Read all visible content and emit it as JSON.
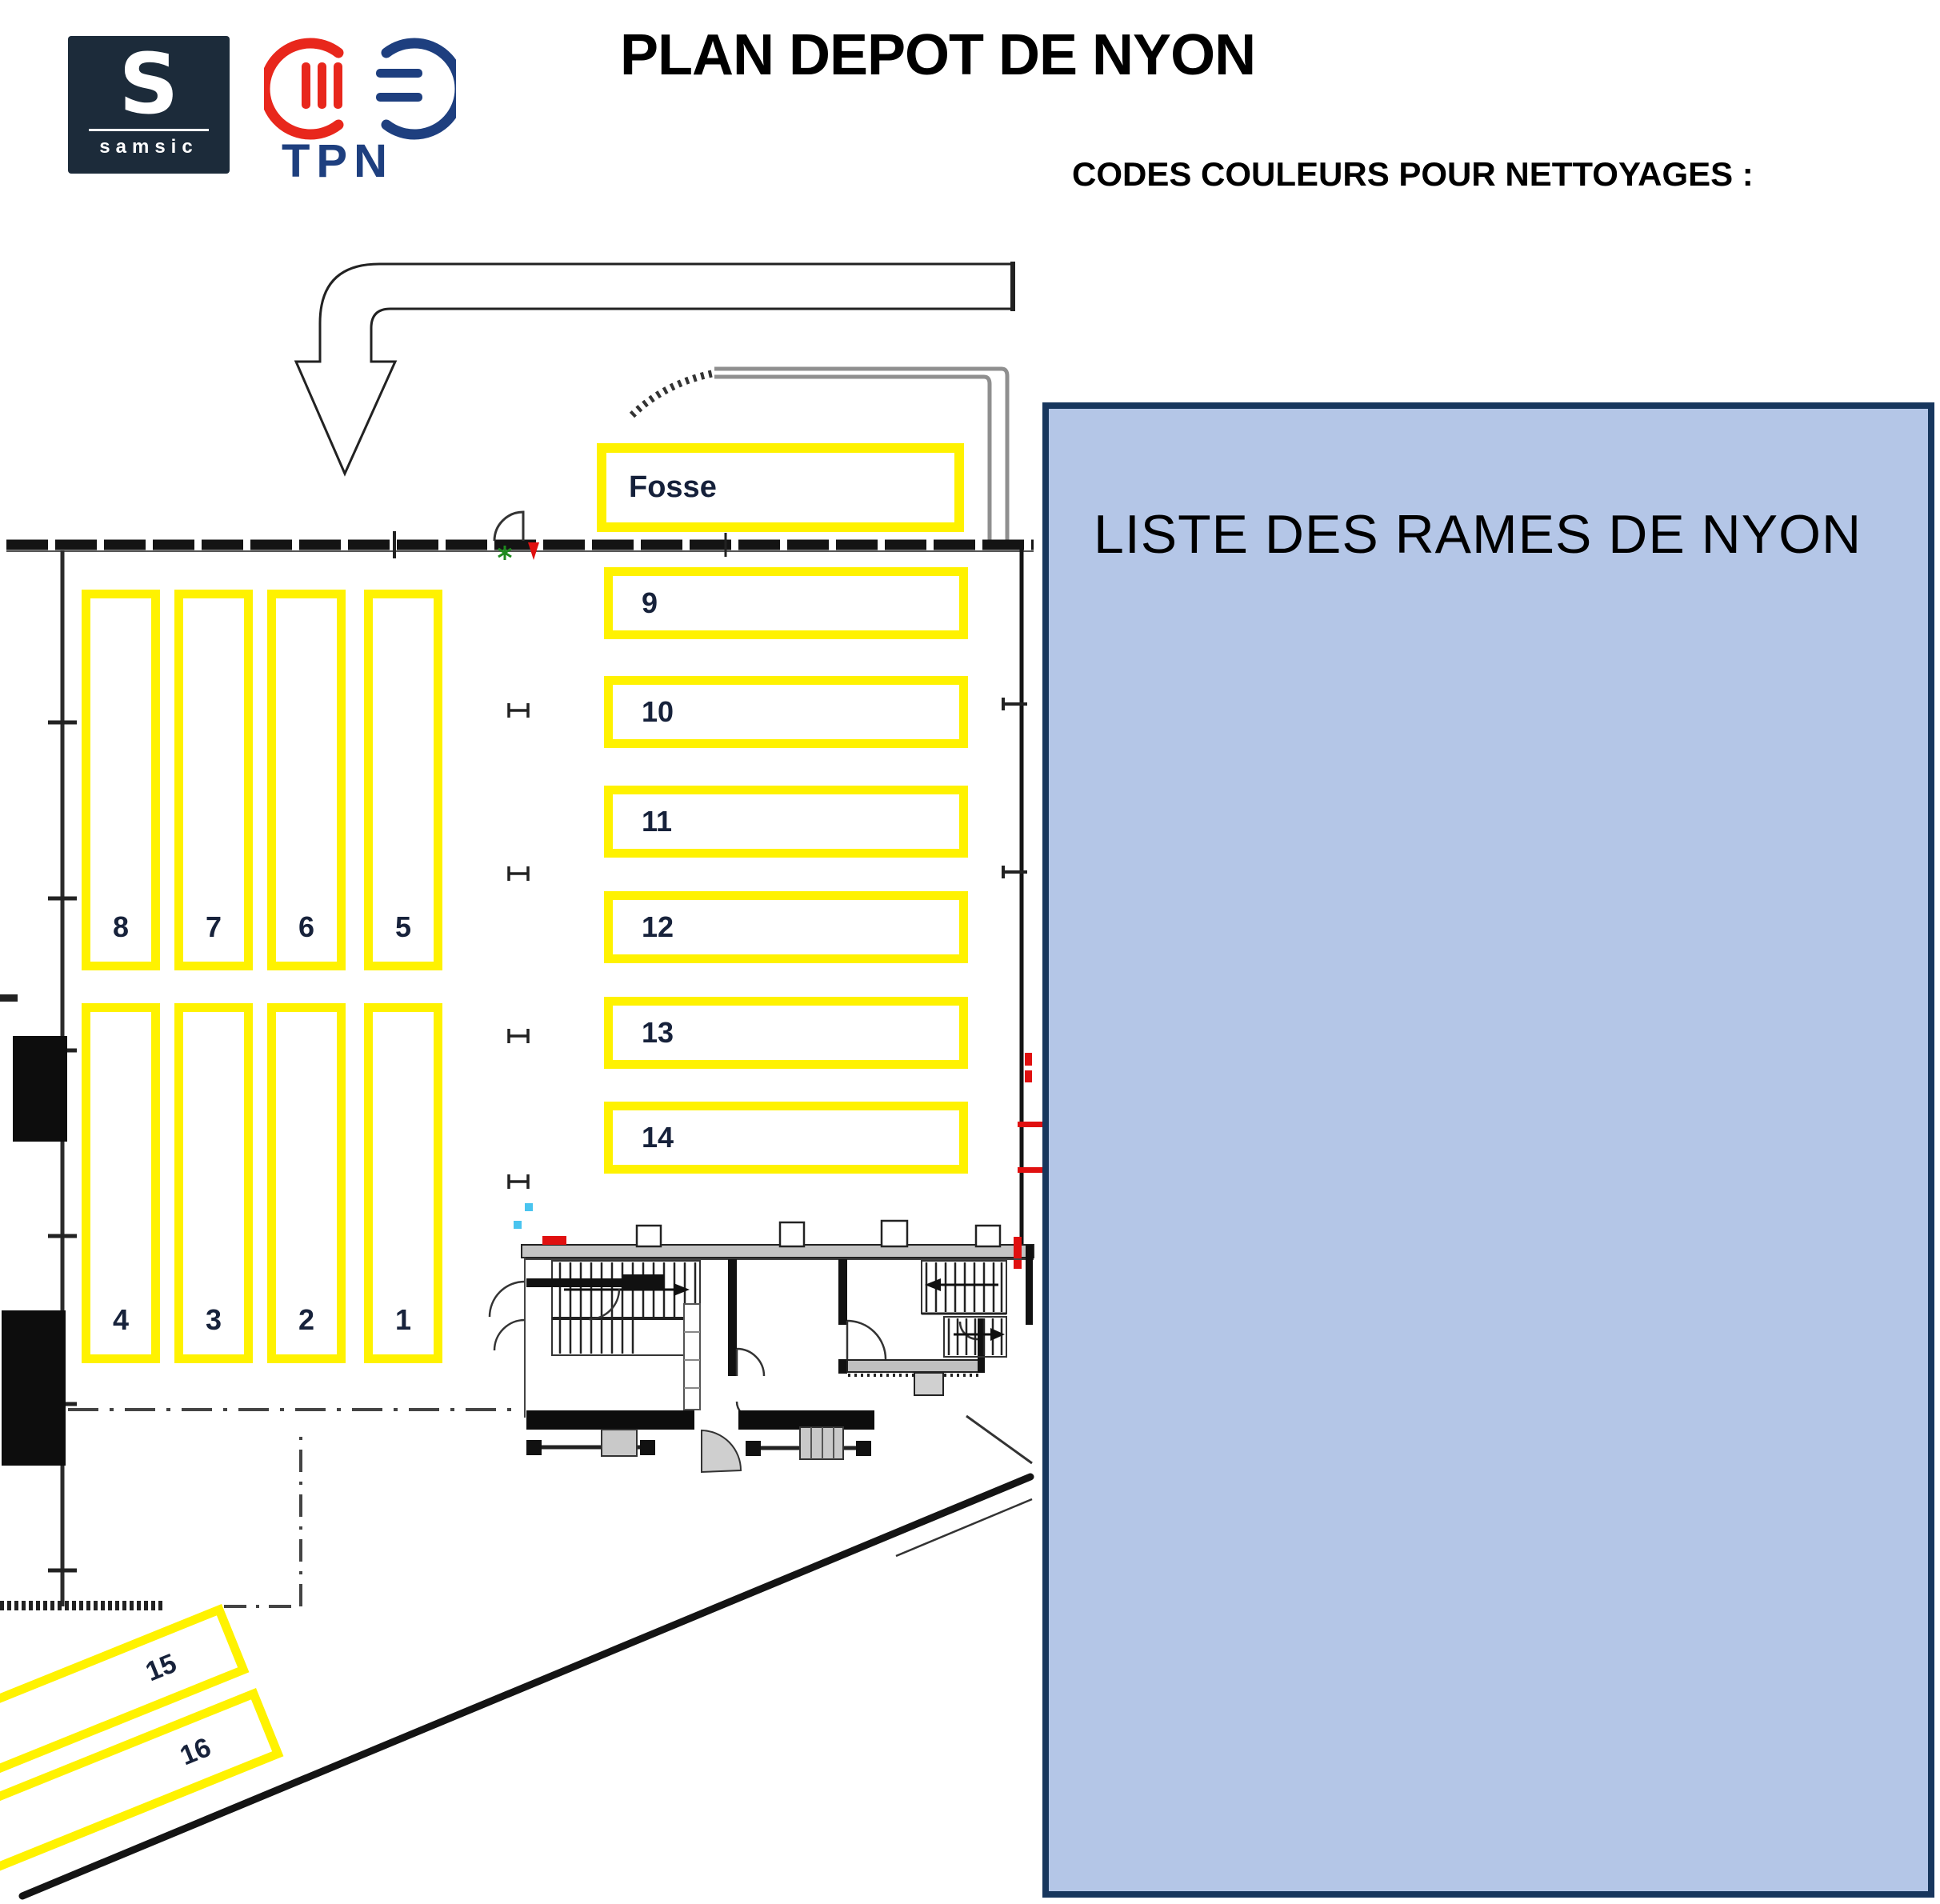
{
  "header": {
    "samsic": {
      "monogram": "S",
      "wordmark": "samsic"
    },
    "tpn": {
      "wordmark": "TPN"
    },
    "title": "PLAN DEPOT DE NYON",
    "subtitle": "CODES COULEURS POUR NETTOYAGES :"
  },
  "plan": {
    "pit_label": "Fosse",
    "horizontal_tracks": [
      "9",
      "10",
      "11",
      "12",
      "13",
      "14"
    ],
    "vertical_tracks_upper": [
      "8",
      "7",
      "6",
      "5"
    ],
    "vertical_tracks_lower": [
      "4",
      "3",
      "2",
      "1"
    ],
    "diagonal_tracks": [
      "15",
      "16"
    ]
  },
  "panel": {
    "title": "LISTE DES RAMES DE NYON"
  },
  "colors": {
    "track_highlight": "#FFF200",
    "panel_fill": "#B4C6E7",
    "panel_border": "#17365D",
    "samsic_navy": "#1C2B3A",
    "tpn_red": "#E8271C",
    "tpn_blue": "#1E3F7F"
  }
}
